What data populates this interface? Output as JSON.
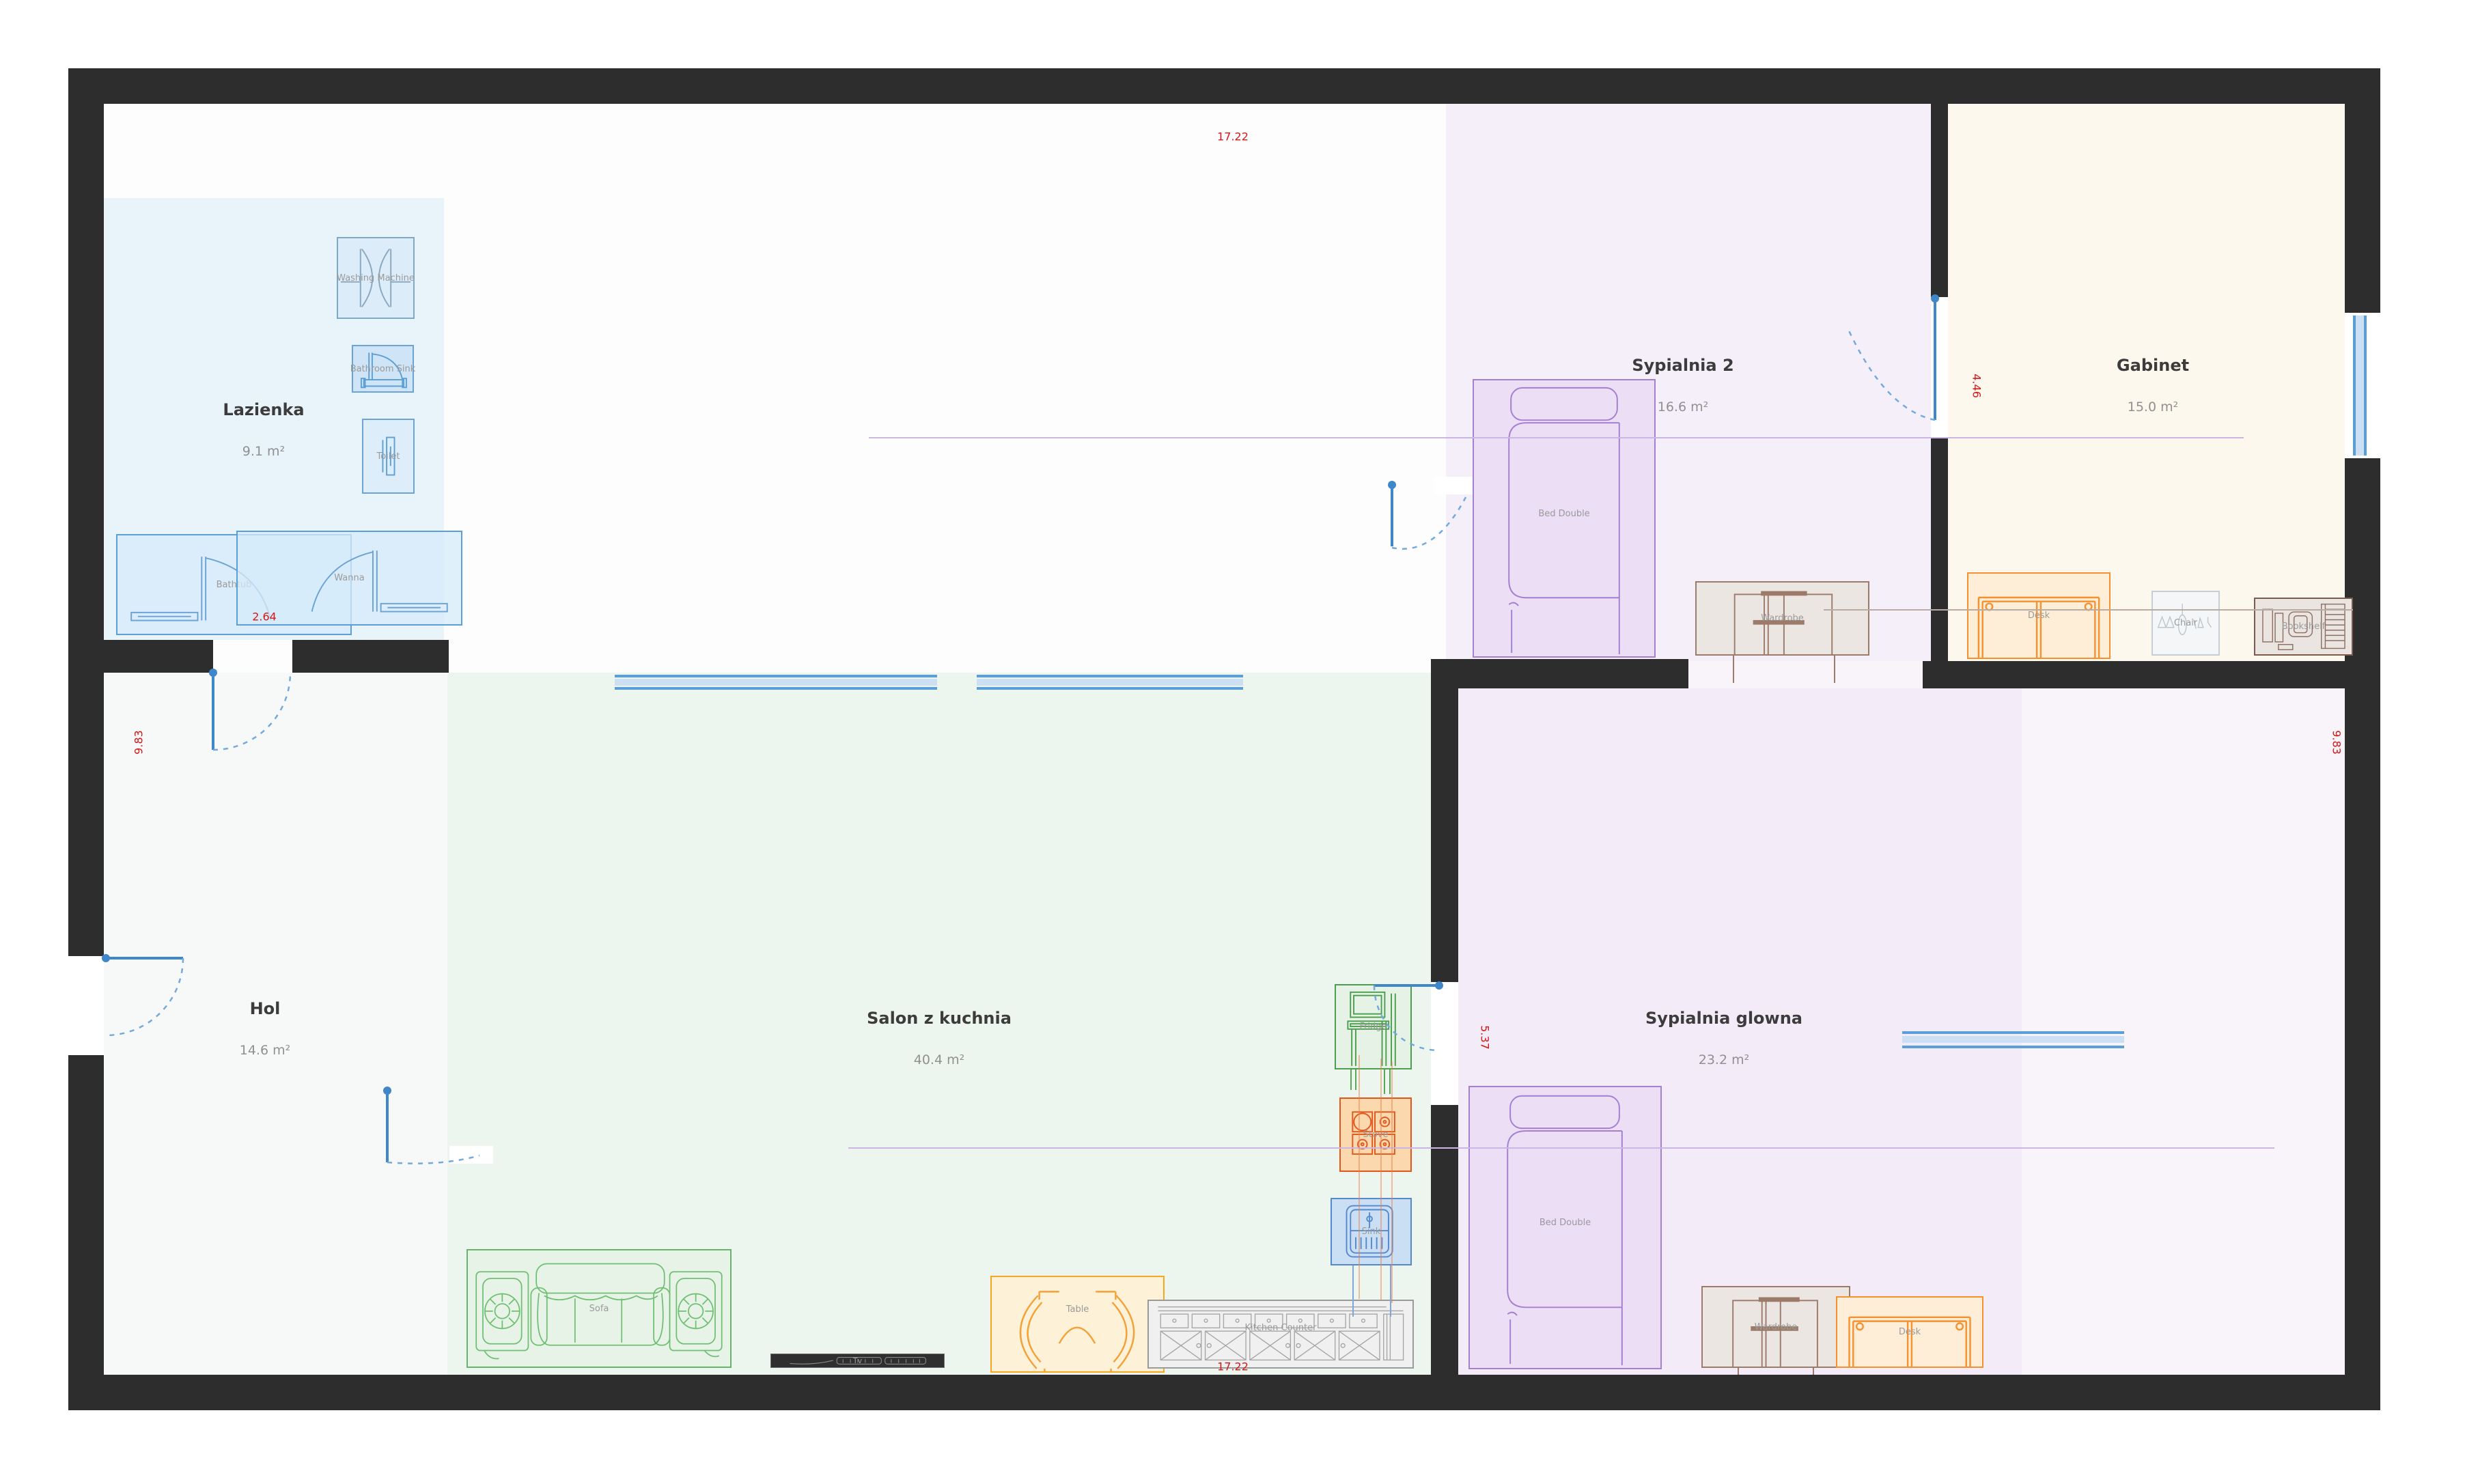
{
  "rooms": {
    "lazienka": {
      "name": "Lazienka",
      "area": "9.1 m²"
    },
    "sypialnia2": {
      "name": "Sypialnia 2",
      "area": "16.6 m²"
    },
    "gabinet": {
      "name": "Gabinet",
      "area": "15.0 m²"
    },
    "hol": {
      "name": "Hol",
      "area": "14.6 m²"
    },
    "salon": {
      "name": "Salon z kuchnia",
      "area": "40.4 m²"
    },
    "sypialnia_glowna": {
      "name": "Sypialnia glowna",
      "area": "23.2 m²"
    }
  },
  "furniture": {
    "washing_machine": "Washing Machine",
    "bathroom_sink": "Bathroom Sink",
    "toilet": "Toilet",
    "bathtub": "Bathtub",
    "wanna": "Wanna",
    "bed_sypialnia2": "Bed Double",
    "wardrobe_sypialnia2": "Wardrobe",
    "desk_gabinet": "Desk",
    "chair_gabinet": "Chair",
    "bookshelf_gabinet": "Bookshelf",
    "sofa": "Sofa",
    "table": "Table",
    "kitchen_counter": "Kitchen Counter",
    "fridge": "Fridge",
    "stove": "Stove",
    "sink": "Sink",
    "tv": "Tv",
    "bed_glowna": "Bed Double",
    "wardrobe_glowna": "Wardrobe",
    "desk_glowna": "Desk"
  },
  "dimensions": {
    "width_top": "17.22",
    "width_bottom": "17.22",
    "height_left": "9.83",
    "height_right": "9.83",
    "bathtub_width": "2.64",
    "gabinet_height": "4.46",
    "glowna_door_height": "5.37"
  },
  "colors": {
    "wall": "#2d2d2d",
    "dimension_text": "#d31616",
    "door_window_blue": "#3f87c9",
    "lazienka_fill": "#e9f3fa",
    "salon_fill": "#edf6ee",
    "bedroom_fill": "#f3ebf8",
    "gabinet_fill": "#fdf8ee"
  }
}
